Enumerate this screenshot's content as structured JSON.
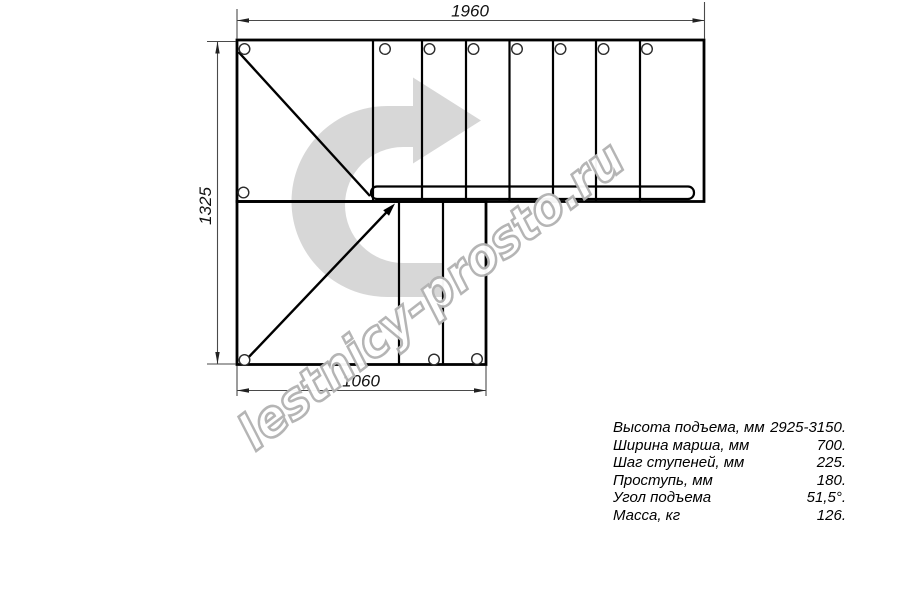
{
  "drawing": {
    "title": "L-shaped staircase plan view",
    "dimensions": {
      "top": "1960",
      "left": "1325",
      "bottom": "1060"
    }
  },
  "arrow": {
    "color": "#d7d7d7"
  },
  "watermark": {
    "text": "lestnicy-prosto.ru",
    "outline_color": "#b2b2b2",
    "fill_color": "#ffffff"
  },
  "colors": {
    "line": "#000000",
    "dim_line": "#4a4a4a",
    "background": "#ffffff"
  },
  "specs": {
    "rows": [
      {
        "label": "Высота подъема, мм",
        "value": "2925-3150."
      },
      {
        "label": "Ширина марша, мм",
        "value": "700."
      },
      {
        "label": "Шаг ступеней, мм",
        "value": "225."
      },
      {
        "label": "Проступь, мм",
        "value": "180."
      },
      {
        "label": "Угол подъема",
        "value": "51,5°."
      },
      {
        "label": "Масса, кг",
        "value": "126."
      }
    ]
  }
}
